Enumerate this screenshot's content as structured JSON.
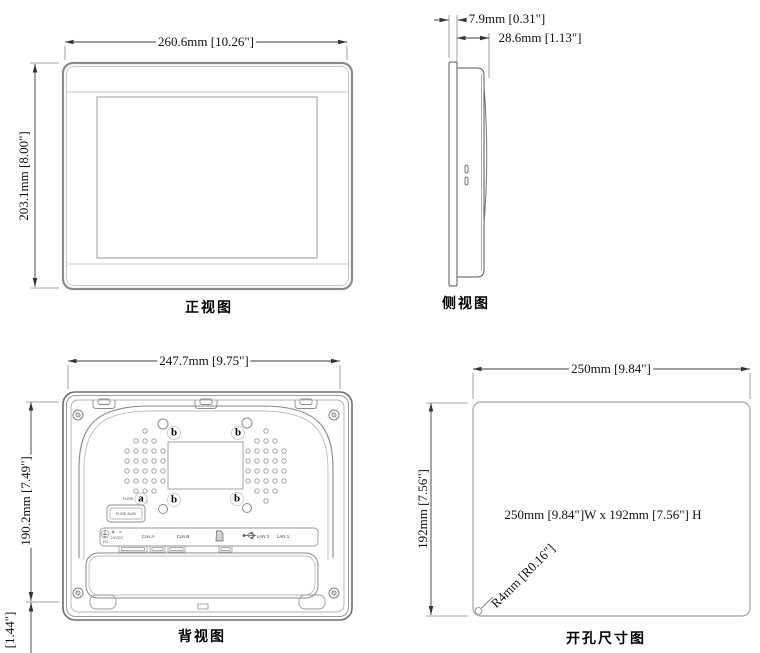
{
  "drawing": {
    "front": {
      "label": "正视图",
      "dim_width": "260.6mm [10.26\"]",
      "dim_height": "203.1mm [8.00\"]"
    },
    "side": {
      "label": "侧视图",
      "dim_bezel_depth": "7.9mm [0.31\"]",
      "dim_total_depth": "28.6mm [1.13\"]"
    },
    "back": {
      "label": "背视图",
      "dim_width": "247.7mm [9.75\"]",
      "dim_height": "190.2mm [7.49\"]",
      "dim_bottom_clearance": "[1.44\"]",
      "callout_a": "a",
      "callout_b": "b",
      "fuse_tag": "FUSE",
      "fuse_box": "FUSE 8x20",
      "ports": {
        "fg": "FG",
        "power": "24VDC",
        "con_a": "Con.A",
        "con_b": "Con.B",
        "lan2": "LAN 2",
        "lan1": "LAN 1"
      }
    },
    "cutout": {
      "label": "开孔尺寸图",
      "dim_width": "250mm [9.84\"]",
      "dim_height": "192mm [7.56\"]",
      "note": "250mm [9.84\"]W x 192mm [7.56\"] H",
      "radius": "R4mm [R0.16\"]"
    }
  },
  "colors": {
    "dim_line": "#3c3c3c",
    "outline": "#8a8a8a",
    "light": "#bdbdbd",
    "text": "#111111"
  }
}
